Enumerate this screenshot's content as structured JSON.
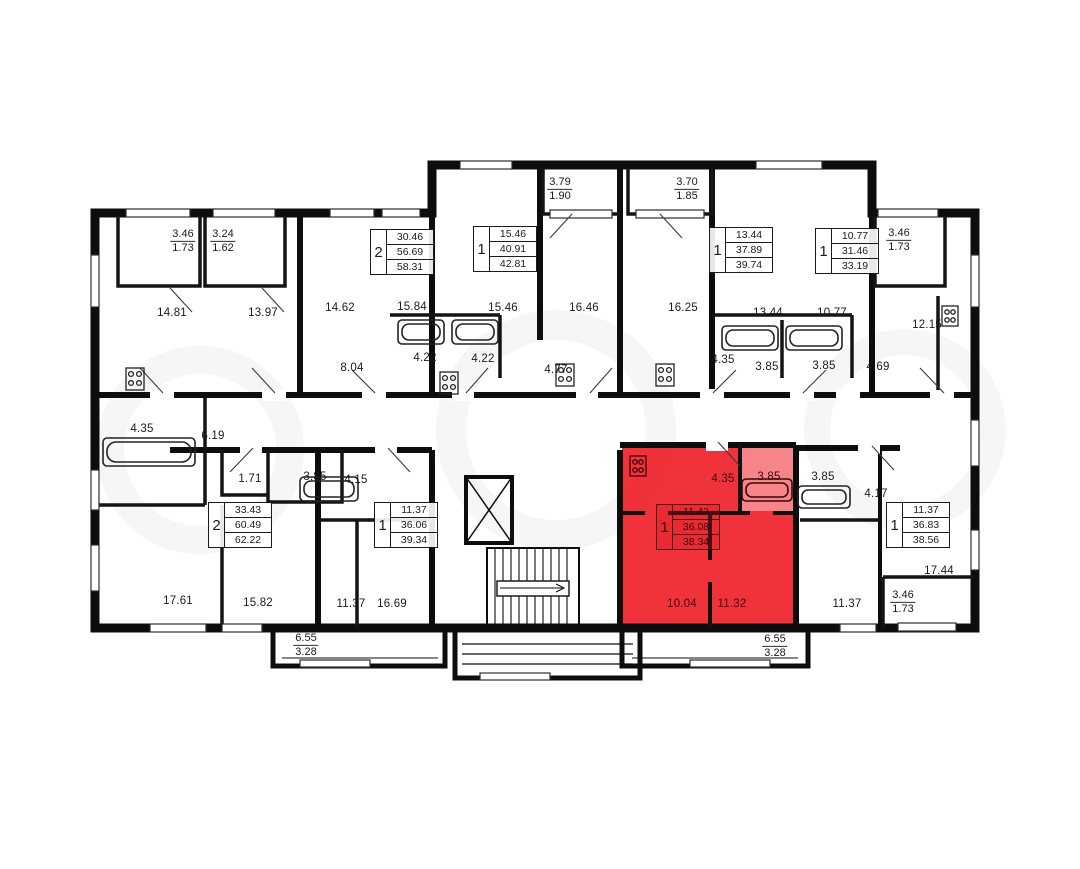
{
  "plan": {
    "highlight_color": "#ee1c25",
    "wall_color": "#0d0d0d",
    "watermark": "avito"
  },
  "units": [
    {
      "rooms": "2",
      "area_living": "30.46",
      "area_total": "56.69",
      "area_full": "58.31"
    },
    {
      "rooms": "1",
      "area_living": "15.46",
      "area_total": "40.91",
      "area_full": "42.81"
    },
    {
      "rooms": "1",
      "area_living": "13.44",
      "area_total": "37.89",
      "area_full": "39.74"
    },
    {
      "rooms": "1",
      "area_living": "10.77",
      "area_total": "31.46",
      "area_full": "33.19"
    },
    {
      "rooms": "2",
      "area_living": "33.43",
      "area_total": "60.49",
      "area_full": "62.22"
    },
    {
      "rooms": "1",
      "area_living": "11.37",
      "area_total": "36.06",
      "area_full": "39.34"
    },
    {
      "rooms": "1",
      "area_living": "11.42",
      "area_total": "36.08",
      "area_full": "38.34",
      "highlighted": true
    },
    {
      "rooms": "1",
      "area_living": "11.37",
      "area_total": "36.83",
      "area_full": "38.56"
    }
  ],
  "room_labels": [
    {
      "text": "14.81"
    },
    {
      "text": "13.97"
    },
    {
      "text": "14.62"
    },
    {
      "text": "15.84"
    },
    {
      "text": "8.04"
    },
    {
      "text": "4.22"
    },
    {
      "text": "4.22"
    },
    {
      "text": "15.46"
    },
    {
      "text": "16.46"
    },
    {
      "text": "16.25"
    },
    {
      "text": "4.77"
    },
    {
      "text": "4.35"
    },
    {
      "text": "13.44"
    },
    {
      "text": "10.77"
    },
    {
      "text": "12.15"
    },
    {
      "text": "3.85"
    },
    {
      "text": "3.85"
    },
    {
      "text": "4.69"
    },
    {
      "text": "4.35"
    },
    {
      "text": "6.19"
    },
    {
      "text": "1.71"
    },
    {
      "text": "3.85"
    },
    {
      "text": "4.15"
    },
    {
      "text": "17.61"
    },
    {
      "text": "15.82"
    },
    {
      "text": "11.37"
    },
    {
      "text": "16.69"
    },
    {
      "text": "4.35"
    },
    {
      "text": "3.85"
    },
    {
      "text": "3.85"
    },
    {
      "text": "4.17"
    },
    {
      "text": "17.44"
    },
    {
      "text": "11.37"
    },
    {
      "text": "10.04"
    },
    {
      "text": "11.32"
    }
  ],
  "balcony_labels": [
    {
      "top": "3.46",
      "bottom": "1.73"
    },
    {
      "top": "3.24",
      "bottom": "1.62"
    },
    {
      "top": "3.79",
      "bottom": "1.90"
    },
    {
      "top": "3.70",
      "bottom": "1.85"
    },
    {
      "top": "3.46",
      "bottom": "1.73"
    },
    {
      "top": "6.55",
      "bottom": "3.28"
    },
    {
      "top": "6.55",
      "bottom": "3.28"
    },
    {
      "top": "3.46",
      "bottom": "1.73"
    }
  ]
}
